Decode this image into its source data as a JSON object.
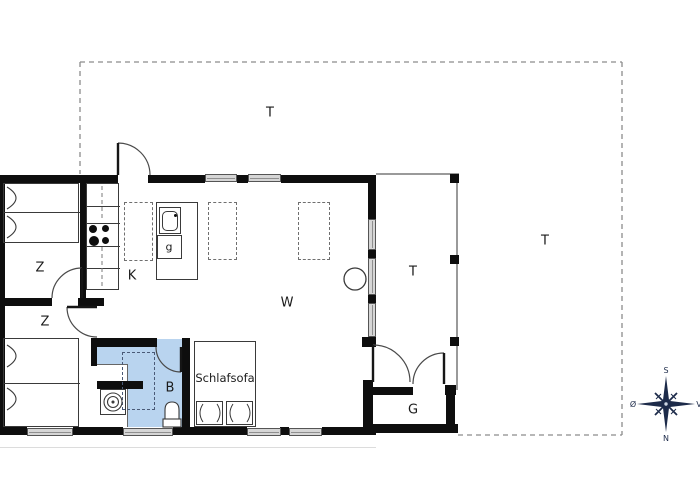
{
  "labels": {
    "terrace_top": "T",
    "terrace_covered": "T",
    "terrace_right": "T",
    "bedroom_upper": "Z",
    "bedroom_lower": "Z",
    "kitchen": "K",
    "living_room": "W",
    "bathroom": "B",
    "shed": "G",
    "appliance_g": "g",
    "sleeper_sofa": "Schlafsofa"
  },
  "compass": {
    "south": "S",
    "north": "N",
    "east": "Ø",
    "west": "V"
  },
  "colors": {
    "wall": "#0e0e0e",
    "bathroom_fill": "#b9d4ef",
    "window_fill": "#d6d6d6",
    "dashed_outline": "#8c8c8c",
    "compass": "#1d2b4a"
  },
  "symbols": [
    "double-bed",
    "double-bed",
    "stove-burners",
    "kitchen-sink",
    "dishwasher",
    "dining-table",
    "dining-table",
    "dining-table",
    "wood-stove",
    "washing-machine",
    "shower",
    "toilet",
    "sleeper-sofa",
    "door-swing",
    "compass-rose"
  ]
}
